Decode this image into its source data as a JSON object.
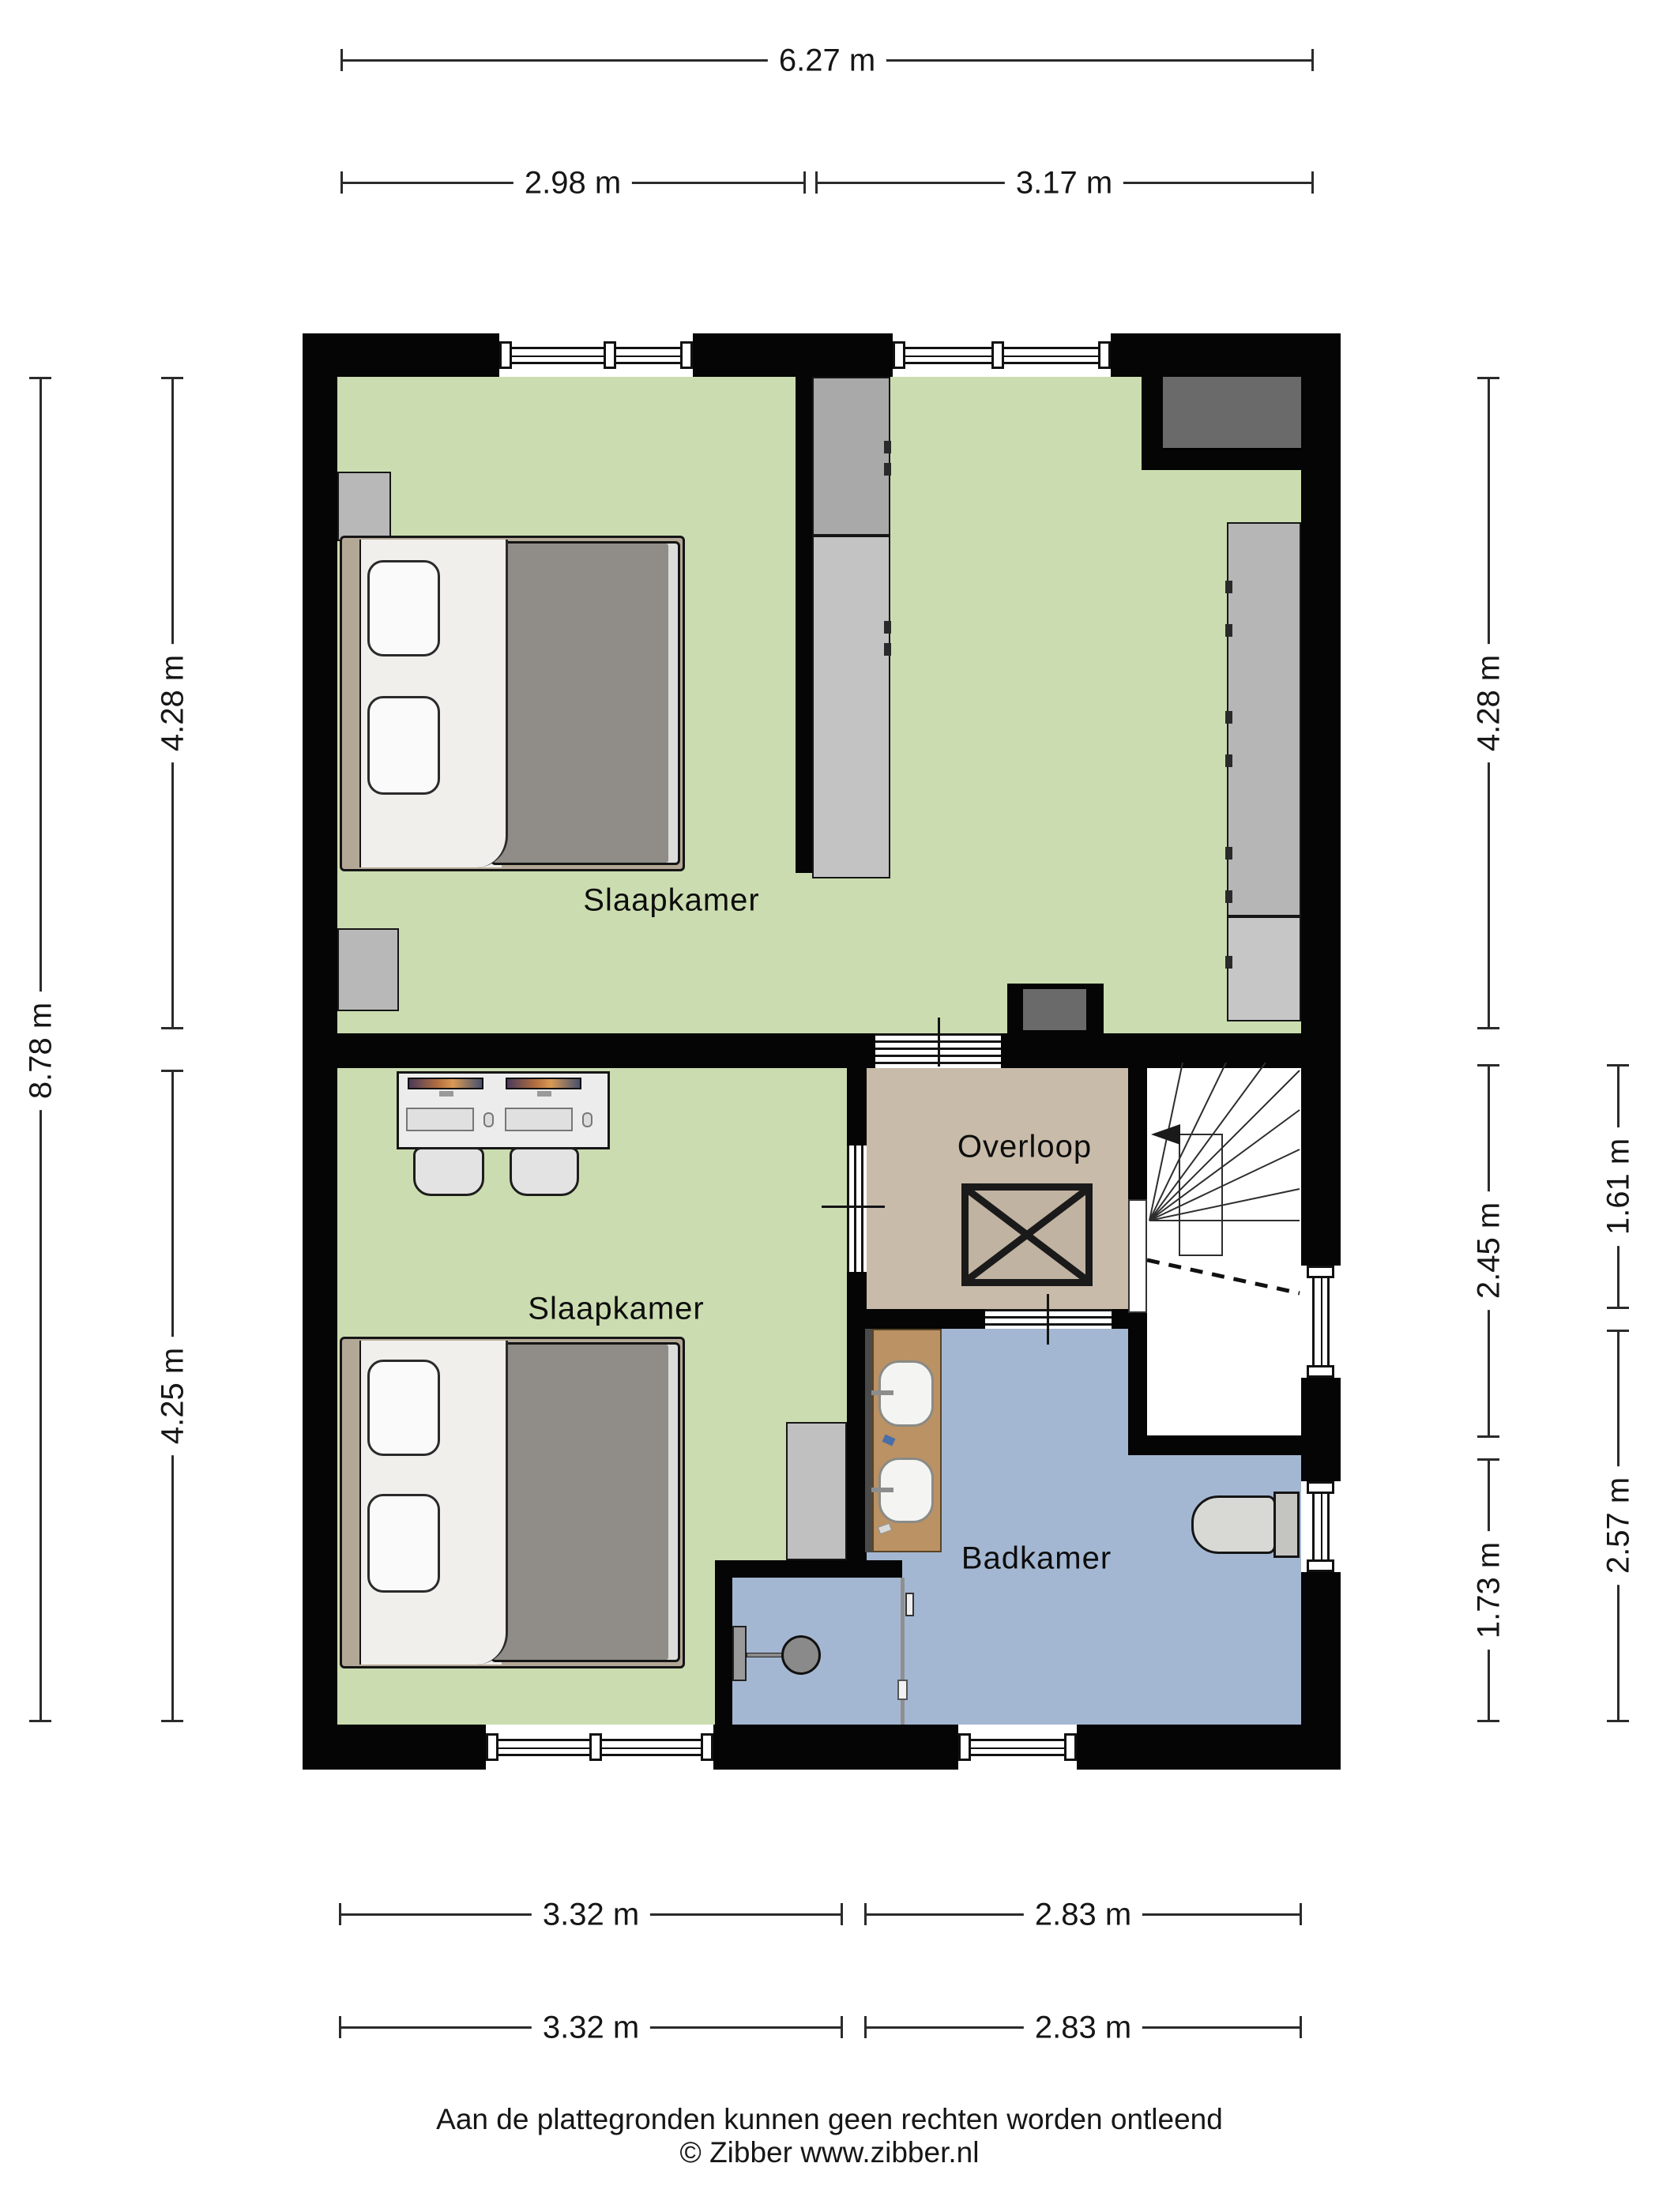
{
  "rooms": {
    "bedroom_top": "Slaapkamer",
    "bedroom_bottom": "Slaapkamer",
    "landing": "Overloop",
    "bathroom": "Badkamer"
  },
  "dims": {
    "top_total": "6.27 m",
    "top_left": "2.98 m",
    "top_right": "3.17 m",
    "left_total": "8.78 m",
    "left_upper": "4.28 m",
    "left_lower": "4.25 m",
    "right_upper": "4.28 m",
    "right_middle": "2.45 m",
    "right_lower": "1.73 m",
    "right_outer_upper": "1.61 m",
    "right_outer_lower": "2.57 m",
    "bottom_row1_left": "3.32 m",
    "bottom_row1_right": "2.83 m",
    "bottom_row2_left": "3.32 m",
    "bottom_row2_right": "2.83 m"
  },
  "footer": {
    "line1": "Aan de plattegronden kunnen geen rechten worden ontleend",
    "line2": "© Zibber www.zibber.nl"
  },
  "colors": {
    "wall": "#050505",
    "floor_bedroom": "#cbddb0",
    "floor_landing": "#c8bba9",
    "floor_bathroom": "#a4b7d2",
    "wood_vanity": "#bb9264",
    "furniture_gray": "#b6b6b6",
    "dark_gray_box": "#6a6a6a",
    "bed_frame": "#b3a896",
    "blanket": "#908c87",
    "dim_line": "#2b2b2b"
  }
}
